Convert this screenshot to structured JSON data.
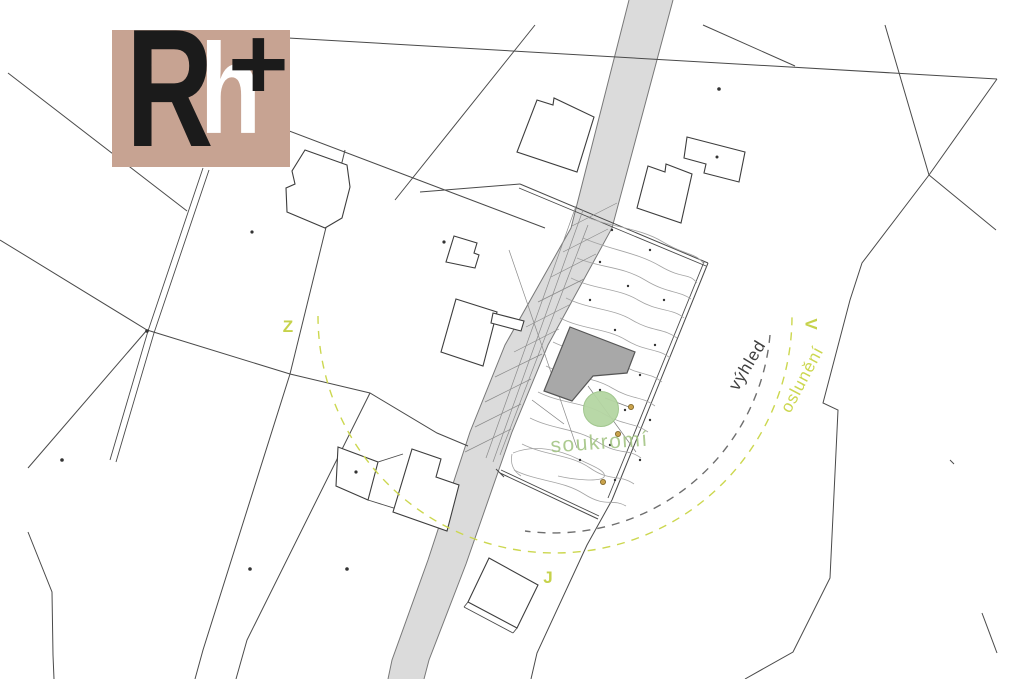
{
  "logo": {
    "letter_r": "R",
    "letter_h": "h",
    "plus": "+"
  },
  "labels": {
    "compass_west": "Z",
    "compass_east": "V",
    "compass_south": "J",
    "view": "výhled",
    "sunlight": "oslunění",
    "privacy": "soukromí"
  },
  "colors": {
    "logo_background": "#c7a392",
    "logo_dark": "#1b1b1b",
    "logo_light": "#ffffff",
    "accent_yellow_green": "#ccd74f",
    "label_gray": "#3f3f3f",
    "privacy_green": "#a4c585",
    "tree_green": "#b5d6a3",
    "road_gray": "#dbdbdb",
    "highlight_building_gray": "#a8a8a8",
    "parcel_line": "#4a4a4a"
  }
}
